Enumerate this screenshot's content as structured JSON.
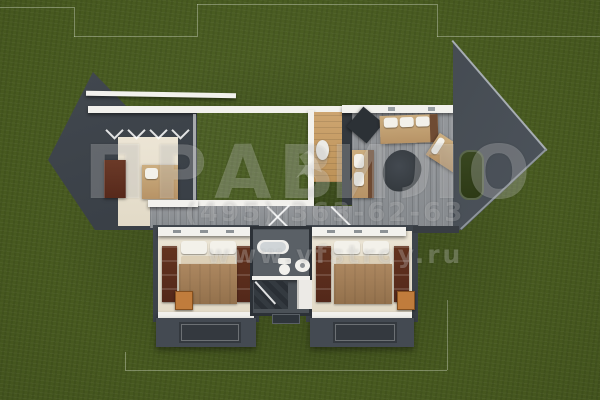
{
  "scene": {
    "type": "3d-top-down-floor-plan-render",
    "background": "lawn"
  },
  "watermark": {
    "brand_letters": [
      "П",
      "Р",
      "А",
      "В",
      "И",
      "Л",
      "О"
    ],
    "phone": "(495) 363-62-63",
    "website": "www.vfstroy.ru"
  },
  "floor_plan": {
    "rooms": [
      {
        "id": "living-room",
        "label": "living room under pergola",
        "furniture": [
          "cabinet",
          "sofa"
        ]
      },
      {
        "id": "courtyard",
        "label": "inner courtyard lawn",
        "furniture": []
      },
      {
        "id": "entry-hall",
        "label": "entry hall",
        "furniture": [
          "plant"
        ]
      },
      {
        "id": "terrace",
        "label": "wood deck terrace",
        "furniture": [
          "sofa",
          "lounge-chair",
          "rug",
          "grill"
        ]
      },
      {
        "id": "hallway",
        "label": "hallway",
        "furniture": []
      },
      {
        "id": "bedroom-left",
        "label": "bedroom",
        "furniture": [
          "double-bed",
          "wardrobe",
          "wardrobe",
          "nightstand",
          "rug"
        ]
      },
      {
        "id": "bedroom-right",
        "label": "bedroom",
        "furniture": [
          "double-bed",
          "wardrobe",
          "wardrobe",
          "nightstand",
          "rug"
        ]
      },
      {
        "id": "bathroom",
        "label": "bathroom",
        "furniture": [
          "bathtub",
          "toilet",
          "washbasin",
          "shower"
        ]
      }
    ]
  },
  "colors": {
    "lawn": "#4a5c24",
    "roof_dark": "#3e444b",
    "deck_planks": "#8d9093",
    "wall_white": "#f2f1ed",
    "floor_beige": "#e8e1d1",
    "wood_tan": "#c89f6a",
    "bed_blanket": "#a07b57",
    "wardrobe_brown": "#5f3526",
    "nightstand_orange": "#c07c3c",
    "sofa_tan": "#c7aa7d",
    "watermark_text": "rgba(255,255,255,0.22)"
  }
}
